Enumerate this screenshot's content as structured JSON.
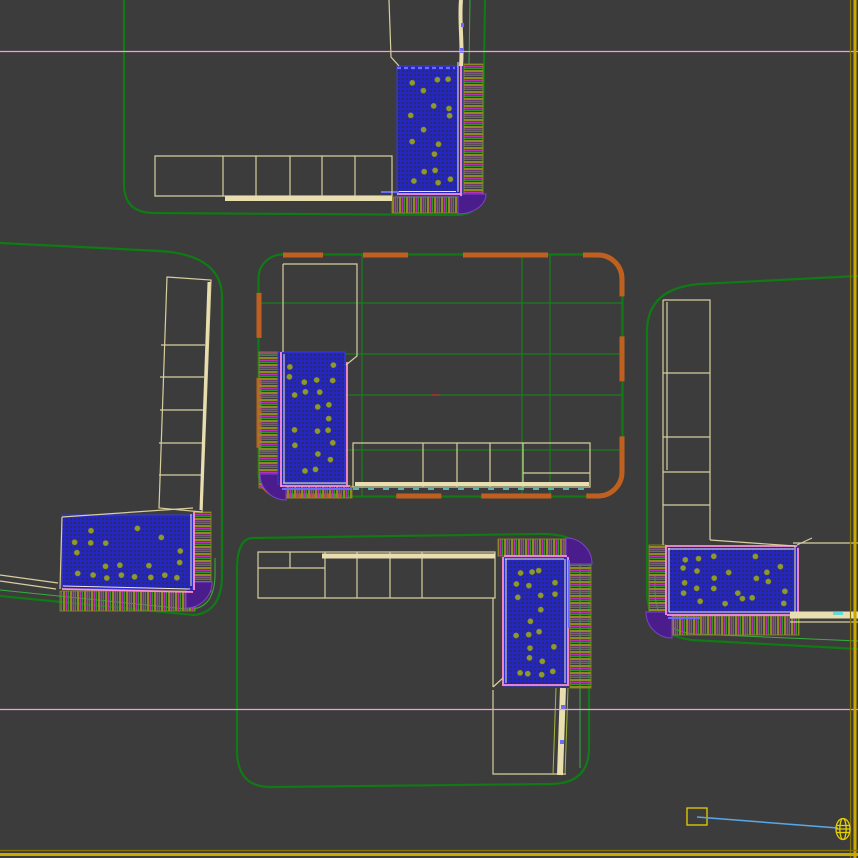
{
  "viewport": {
    "kind": "3d-top-view-site-plan",
    "visible_text": "none",
    "border_edges_highlighted": [
      "right",
      "bottom"
    ]
  },
  "colors": {
    "background": "#3c3c3c",
    "road_green": "#107a14",
    "light_green": "#35b03a",
    "grid_green": "#0f8c12",
    "orange": "#c06020",
    "cream": "#d8cf9e",
    "cream_thick": "#e9deb0",
    "pink": "#ff8fd2",
    "white_line": "#efe9d8",
    "veg_blue": "#2526c0",
    "veg_dark": "#2d2d40",
    "tree_olive": "#8c9c2c",
    "hedge_olive": "#8c8c1e",
    "hedge_magenta": "#bb2dbb",
    "hedge_green": "#2f9b2f",
    "purple": "#4a1c8c",
    "purple_light": "#7a44c8",
    "periwinkle": "#6a6aff",
    "construction_pink": "#f2a0d8",
    "vp_yellow": "#c9a800",
    "vp_yellow_dark": "#8a7400",
    "gizmo_yellow": "#e5d000",
    "target_blue": "#58a8e8",
    "red_mark": "#b03030",
    "cyan": "#62d8d8",
    "yellowgreen": "#a2b63c"
  },
  "scene_objects": [
    "top-block",
    "left-block",
    "center-block",
    "right-block",
    "bottom-block",
    "park-areas",
    "hedge-bands",
    "building-footprints",
    "construction-lines",
    "light-gizmo",
    "target-line"
  ],
  "vegetation_areas": [
    {
      "id": "park-top",
      "cols": 4,
      "rows": 9,
      "keep": 0.55
    },
    {
      "id": "park-center",
      "cols": 4,
      "rows": 9,
      "keep": 0.55
    },
    {
      "id": "park-left",
      "cols": 8,
      "rows": 5,
      "keep": 0.55
    },
    {
      "id": "park-right",
      "cols": 8,
      "rows": 5,
      "keep": 0.55
    },
    {
      "id": "park-bottom",
      "cols": 4,
      "rows": 9,
      "keep": 0.55
    }
  ],
  "construction_lines_y": [
    51,
    709
  ],
  "gizmo": {
    "square": "selection-marker",
    "sphere": "light-object",
    "link": "target-line"
  }
}
